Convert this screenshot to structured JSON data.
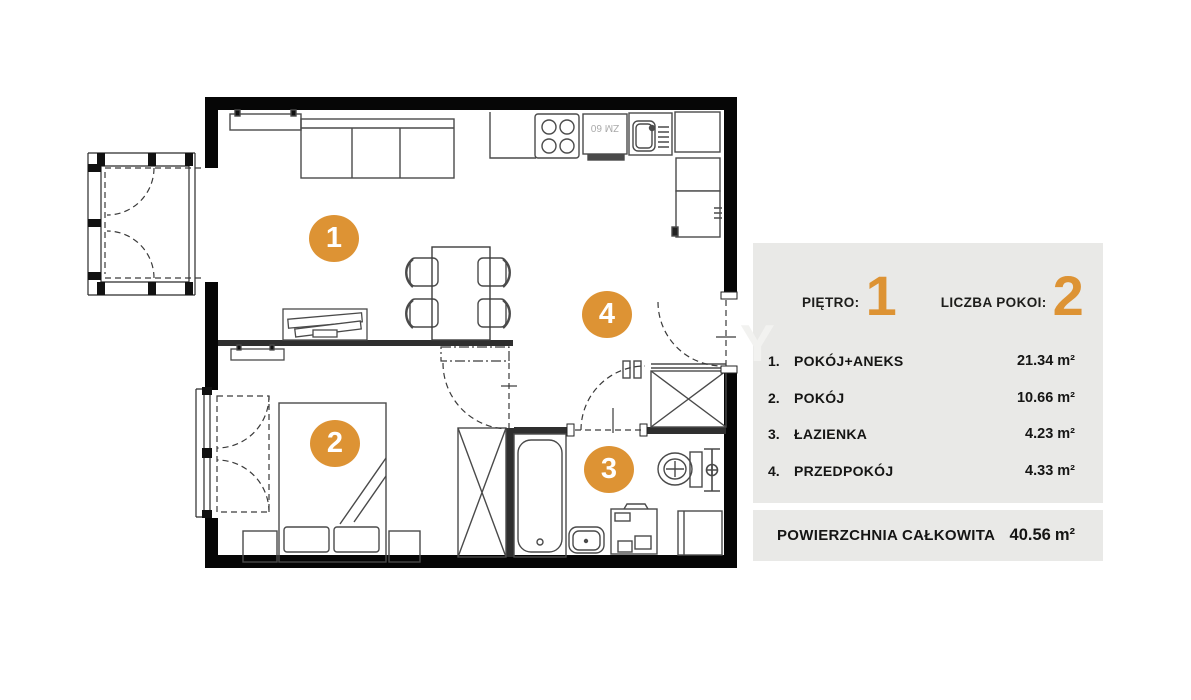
{
  "colors": {
    "accent": "#DD9334",
    "panel_bg": "#E9E9E7",
    "text": "#1D1D1B",
    "wall": "#060606",
    "line": "#4A4A4A"
  },
  "plan": {
    "markers": [
      "1",
      "2",
      "3",
      "4"
    ],
    "appliance_label": "ZM 60",
    "watermark": "Y"
  },
  "legend": {
    "floor_label": "PIĘTRO:",
    "floor_value": "1",
    "rooms_label": "LICZBA POKOI:",
    "rooms_value": "2",
    "rooms": [
      {
        "no": "1.",
        "name": "POKÓJ+ANEKS",
        "area": "21.34",
        "unit": "m²"
      },
      {
        "no": "2.",
        "name": "POKÓJ",
        "area": "10.66",
        "unit": "m²"
      },
      {
        "no": "3.",
        "name": "ŁAZIENKA",
        "area": "4.23",
        "unit": "m²"
      },
      {
        "no": "4.",
        "name": "PRZEDPOKÓJ",
        "area": "4.33",
        "unit": "m²"
      }
    ],
    "total_label": "POWIERZCHNIA CAŁKOWITA",
    "total_area": "40.56",
    "total_unit": "m²"
  }
}
